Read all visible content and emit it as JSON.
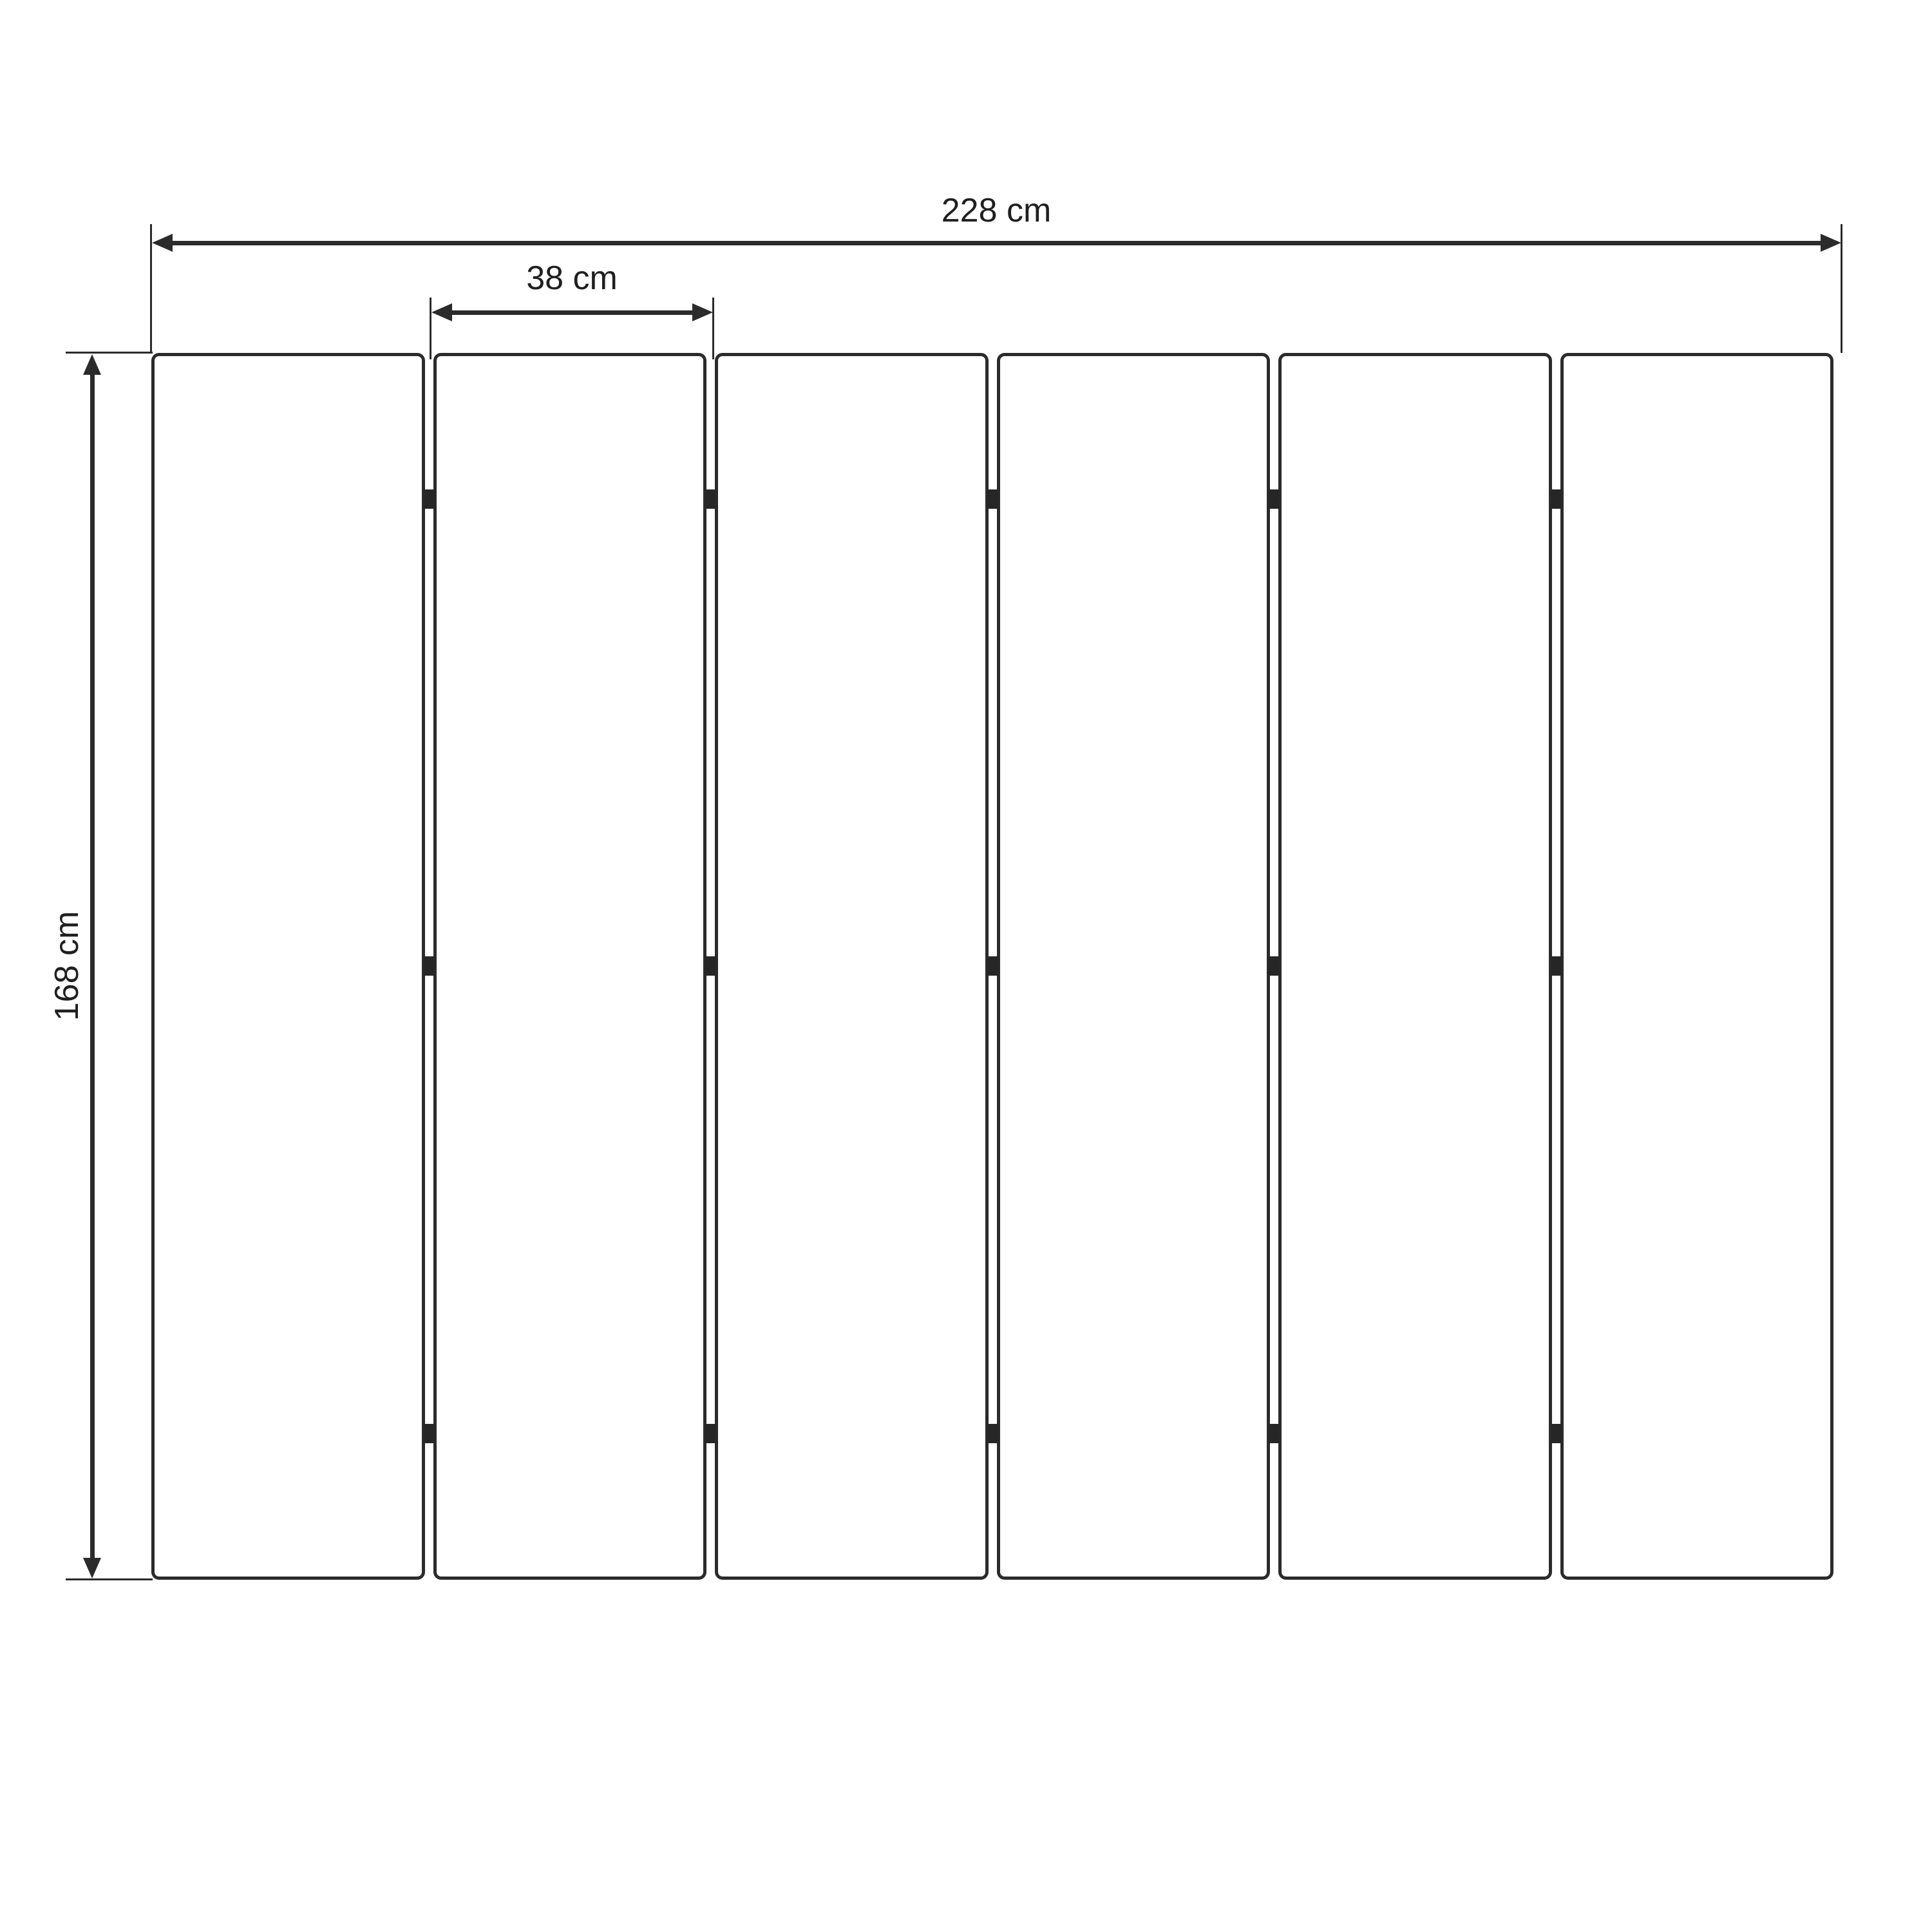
{
  "diagram": {
    "type": "furniture-dimension-drawing",
    "subject": "six-panel folding screen, front view",
    "panels": {
      "count": 6,
      "gap_count": 5,
      "hinges_per_gap": 3
    },
    "dimensions": {
      "total_width": {
        "label": "228 cm",
        "position": "top"
      },
      "panel_width": {
        "label": "38 cm",
        "position": "above panel 2"
      },
      "height": {
        "label": "168 cm",
        "position": "left, rotated"
      }
    },
    "colors": {
      "background": "#ffffff",
      "line": "#2b2b2b",
      "text": "#1f1f1f"
    }
  }
}
